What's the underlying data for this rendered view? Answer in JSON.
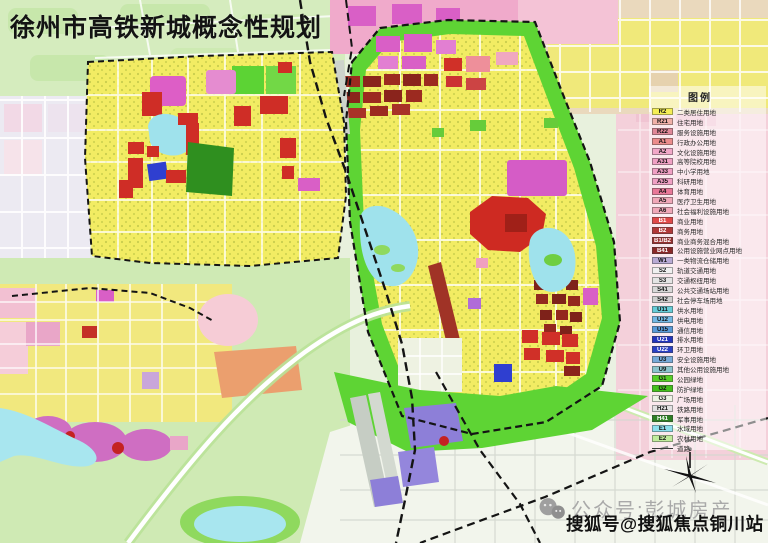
{
  "title": "徐州市高铁新城概念性规划",
  "legend": {
    "title": "图例",
    "items": [
      {
        "code": "R2",
        "label": "二类居住用地",
        "color": "#f5ee55",
        "tc": "#111"
      },
      {
        "code": "R21",
        "label": "住宅用地",
        "color": "#f0b0a8",
        "tc": "#111"
      },
      {
        "code": "R22",
        "label": "服务设施用地",
        "color": "#e08898",
        "tc": "#111"
      },
      {
        "code": "A1",
        "label": "行政办公用地",
        "color": "#ec8c8c",
        "tc": "#111"
      },
      {
        "code": "A2",
        "label": "文化设施用地",
        "color": "#f2a8c8",
        "tc": "#111"
      },
      {
        "code": "A31",
        "label": "高等院校用地",
        "color": "#f0a0c4",
        "tc": "#111"
      },
      {
        "code": "A33",
        "label": "中小学用地",
        "color": "#f0a0c4",
        "tc": "#111"
      },
      {
        "code": "A35",
        "label": "科研用地",
        "color": "#f0a0c4",
        "tc": "#111"
      },
      {
        "code": "A4",
        "label": "体育用地",
        "color": "#e87898",
        "tc": "#111"
      },
      {
        "code": "A5",
        "label": "医疗卫生用地",
        "color": "#f0a8b8",
        "tc": "#111"
      },
      {
        "code": "A6",
        "label": "社会福利设施用地",
        "color": "#f0a8b8",
        "tc": "#111"
      },
      {
        "code": "B1",
        "label": "商业用地",
        "color": "#e04848",
        "tc": "#fff"
      },
      {
        "code": "B2",
        "label": "商务用地",
        "color": "#b03838",
        "tc": "#fff"
      },
      {
        "code": "B1/B2",
        "label": "商业商务混合用地",
        "color": "#993030",
        "tc": "#fff"
      },
      {
        "code": "B41",
        "label": "公用设施营业网点用地",
        "color": "#8a2828",
        "tc": "#fff"
      },
      {
        "code": "W1",
        "label": "一类物流仓储用地",
        "color": "#b8aad4",
        "tc": "#111"
      },
      {
        "code": "S2",
        "label": "轨道交通用地",
        "color": "#f0f0f0",
        "tc": "#111"
      },
      {
        "code": "S3",
        "label": "交通枢纽用地",
        "color": "#e4e4e4",
        "tc": "#111"
      },
      {
        "code": "S41",
        "label": "公共交通场站用地",
        "color": "#d8d8d8",
        "tc": "#111"
      },
      {
        "code": "S42",
        "label": "社会停车场用地",
        "color": "#cfcfcf",
        "tc": "#111"
      },
      {
        "code": "U11",
        "label": "供水用地",
        "color": "#66ccd8",
        "tc": "#111"
      },
      {
        "code": "U12",
        "label": "供电用地",
        "color": "#74b8e4",
        "tc": "#111"
      },
      {
        "code": "U15",
        "label": "通信用地",
        "color": "#5a9ad8",
        "tc": "#111"
      },
      {
        "code": "U21",
        "label": "排水用地",
        "color": "#2434bc",
        "tc": "#fff"
      },
      {
        "code": "U22",
        "label": "环卫用地",
        "color": "#2c40c4",
        "tc": "#fff"
      },
      {
        "code": "U3",
        "label": "安全设施用地",
        "color": "#78aad8",
        "tc": "#111"
      },
      {
        "code": "U9",
        "label": "其他公用设施用地",
        "color": "#8cc4cc",
        "tc": "#111"
      },
      {
        "code": "G1",
        "label": "公园绿地",
        "color": "#58d028",
        "tc": "#111"
      },
      {
        "code": "G2",
        "label": "防护绿地",
        "color": "#44c01c",
        "tc": "#111"
      },
      {
        "code": "G3",
        "label": "广场用地",
        "color": "#eef4e6",
        "tc": "#111"
      },
      {
        "code": "H21",
        "label": "铁路用地",
        "color": "#e2e2e2",
        "tc": "#111"
      },
      {
        "code": "H41",
        "label": "军事用地",
        "color": "#2e8024",
        "tc": "#fff"
      },
      {
        "code": "E1",
        "label": "水域用地",
        "color": "#8ce0ec",
        "tc": "#111"
      },
      {
        "code": "E2",
        "label": "农林用地",
        "color": "#c0ec9c",
        "tc": "#111"
      },
      {
        "code": "",
        "label": "道路",
        "color": "",
        "tc": "#111",
        "type": "line"
      }
    ]
  },
  "watermarks": {
    "wechat": "公众号:彭城房产",
    "sohu": "搜狐号@搜狐焦点铜川站"
  }
}
